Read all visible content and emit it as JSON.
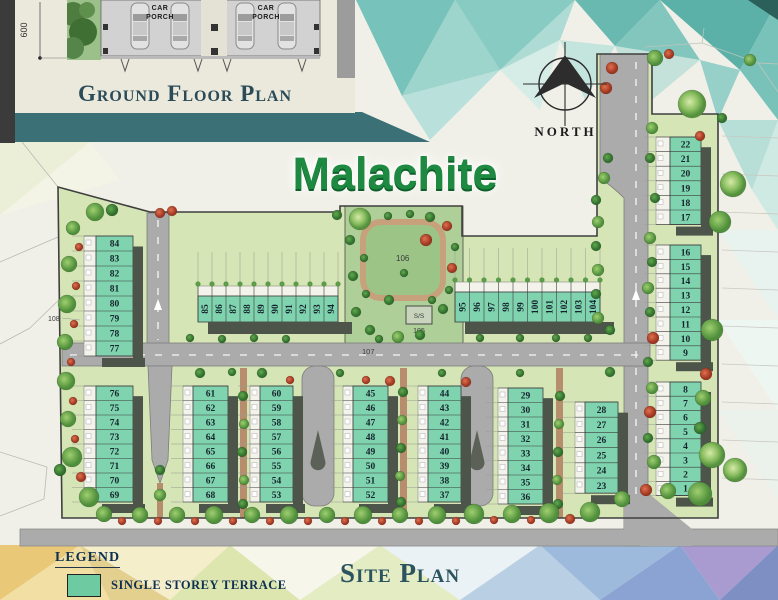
{
  "title": "Malachite",
  "compass": {
    "label": "NORTH"
  },
  "inset": {
    "dimension_label": "600",
    "car_porch_line1": "CAR",
    "car_porch_line2": "PORCH",
    "caption": "Ground Floor Plan"
  },
  "site_caption": "Site Plan",
  "legend": {
    "heading": "LEGEND",
    "items": [
      {
        "label": "SINGLE STOREY TERRACE",
        "color": "#6ecba1"
      }
    ]
  },
  "map_labels": {
    "main_road": "107",
    "west_boundary": "108",
    "park": "106",
    "substation": "S/S",
    "substation_lot": "105"
  },
  "blocks": [
    {
      "id": "lt",
      "lots": [
        "84",
        "83",
        "82",
        "81",
        "80",
        "79",
        "78",
        "77"
      ]
    },
    {
      "id": "lb",
      "lots": [
        "76",
        "75",
        "74",
        "73",
        "72",
        "71",
        "70",
        "69"
      ]
    },
    {
      "id": "mw",
      "lots": [
        "85",
        "86",
        "87",
        "88",
        "89",
        "90",
        "91",
        "92",
        "93",
        "94"
      ]
    },
    {
      "id": "me",
      "lots": [
        "95",
        "96",
        "97",
        "98",
        "99",
        "100",
        "101",
        "102",
        "103",
        "104"
      ]
    },
    {
      "id": "r1",
      "lots": [
        "22",
        "21",
        "20",
        "19",
        "18",
        "17"
      ]
    },
    {
      "id": "r2",
      "lots": [
        "16",
        "15",
        "14",
        "13",
        "12",
        "11",
        "10",
        "9"
      ]
    },
    {
      "id": "r3",
      "lots": [
        "8",
        "7",
        "6",
        "5",
        "4",
        "3",
        "2",
        "1"
      ]
    },
    {
      "id": "b1",
      "lots": [
        "61",
        "62",
        "63",
        "64",
        "65",
        "66",
        "67",
        "68"
      ]
    },
    {
      "id": "b2",
      "lots": [
        "60",
        "59",
        "58",
        "57",
        "56",
        "55",
        "54",
        "53"
      ]
    },
    {
      "id": "c1",
      "lots": [
        "45",
        "46",
        "47",
        "48",
        "49",
        "50",
        "51",
        "52"
      ]
    },
    {
      "id": "c2",
      "lots": [
        "44",
        "43",
        "42",
        "41",
        "40",
        "39",
        "38",
        "37"
      ]
    },
    {
      "id": "d1",
      "lots": [
        "29",
        "30",
        "31",
        "32",
        "33",
        "34",
        "35",
        "36"
      ]
    },
    {
      "id": "d2",
      "lots": [
        "28",
        "27",
        "26",
        "25",
        "24",
        "23"
      ]
    }
  ],
  "colors": {
    "lot_fill": "#7fd3af",
    "house_strip": "#4d554b",
    "grass": "#d5e5b5",
    "park": "#aecf97",
    "road": "#ababab",
    "path_brown": "#b68e6d",
    "band": "#3b7076",
    "accent_green": "#1e8a41",
    "heading": "#2a4b57"
  }
}
